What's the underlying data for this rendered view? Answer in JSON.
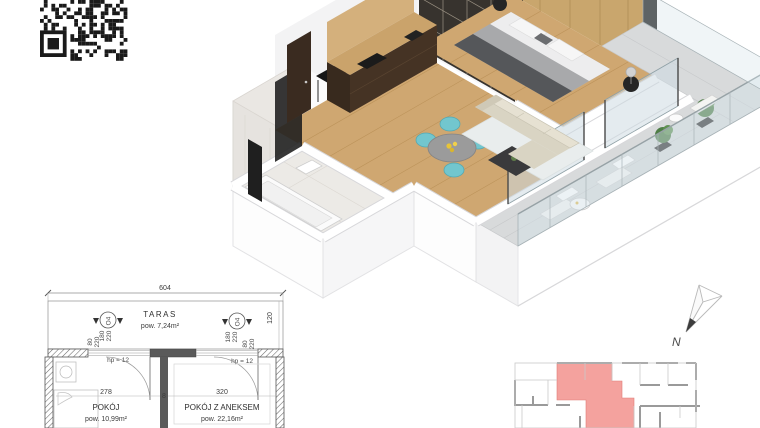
{
  "colors": {
    "highlight_unit": "#f2928d",
    "wood_floor": "#cfa771",
    "teal_chair": "#72c6ce",
    "plan_line": "#4a4a4a"
  },
  "floor_plan": {
    "overall_width": "604",
    "terrace_depth": "120",
    "terrace": {
      "label": "TARAS",
      "area": "pow. 7,24m²"
    },
    "windows": [
      {
        "code": "O4",
        "h1": "180",
        "h2": "220",
        "s1": "80",
        "s2": "220",
        "parapet": "hp = 12"
      },
      {
        "code": "O4",
        "h1": "180",
        "h2": "220",
        "s1": "80",
        "s2": "220",
        "parapet": "hp = 12"
      }
    ],
    "middle_wall": "8",
    "rooms": [
      {
        "width": "278",
        "label": "POKÓJ",
        "area": "pow. 10,99m²"
      },
      {
        "width": "320",
        "label": "POKÓJ Z ANEKSEM",
        "area": "pow. 22,16m²"
      }
    ]
  },
  "compass": {
    "north": "N"
  }
}
